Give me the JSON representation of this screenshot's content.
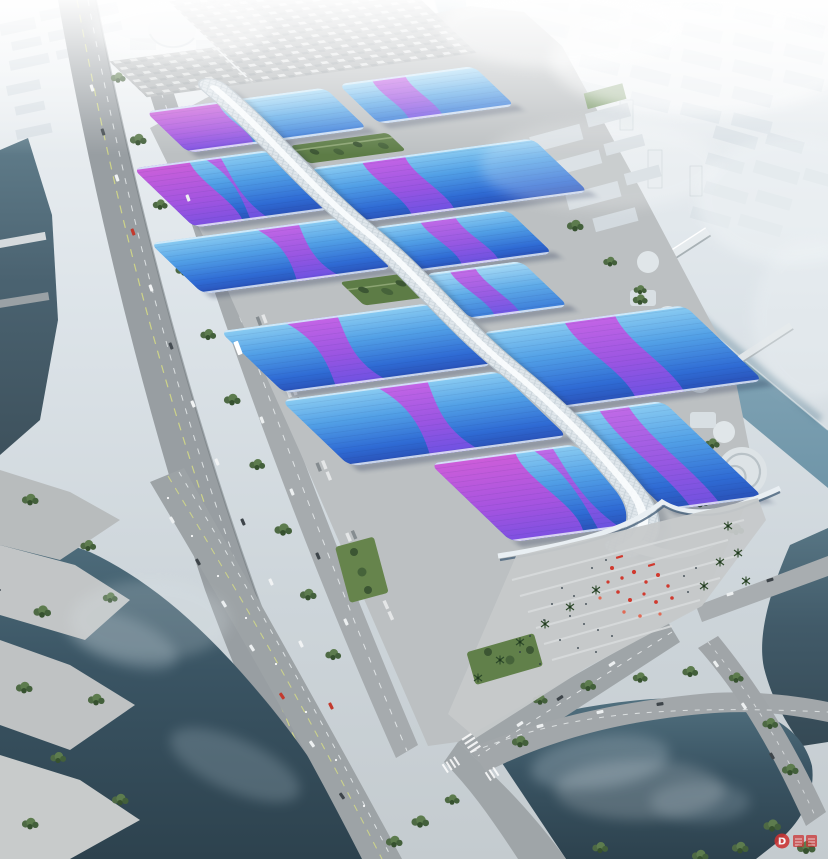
{
  "meta": {
    "kind": "architectural-aerial-rendering",
    "subject": "Bird's-eye rendering of a mega exhibition and convention center: staggered halls with blue gradient roofs crossed by purple ribbon stripes, a white serpentine skylight corridor along the central axis, hazy city skyline behind, rivers, an elevated highway, tree-lined boulevards, a waterfront park and an entrance plaza with red festival decorations and palm trees"
  },
  "watermark": {
    "logo_letter": "D"
  },
  "palette": {
    "haze_white": "#f0f4f6",
    "sky_gray": "#c6ced3",
    "roof_blue_light": "#8ccdf2",
    "roof_blue_mid": "#4f9ce4",
    "roof_blue_deep": "#2b58c8",
    "ribbon_magenta": "#c653e2",
    "ribbon_violet": "#7452e6",
    "corridor_white": "#e9eff3",
    "pavement_gray": "#bcc0c2",
    "road_gray": "#9aa0a4",
    "water_river_steel": "#8fb0c0",
    "water_dark": "#2e4450",
    "tree_green": "#5d7c4e",
    "lawn_green": "#61804a",
    "decor_red": "#d0392e"
  },
  "scene": {
    "background": [
      "hazy city blocks",
      "dome buildings",
      "parking lots with cars"
    ],
    "complex": {
      "hall_rows": 6,
      "roof_style": "blue gradient with purple ribbon sweeps",
      "central_corridor": "white diamond-textured serpentine tube",
      "garden_strips": 2,
      "south_hall": "wavy white-edged front with purple swash"
    },
    "surroundings": [
      "elevated highway with lane markings",
      "tree rows",
      "river with four bridges",
      "dark waterfront basin",
      "crossing boulevards with zebra crossings",
      "spiral riverside building",
      "entrance plaza with red decor, crowds and palm trees"
    ]
  }
}
